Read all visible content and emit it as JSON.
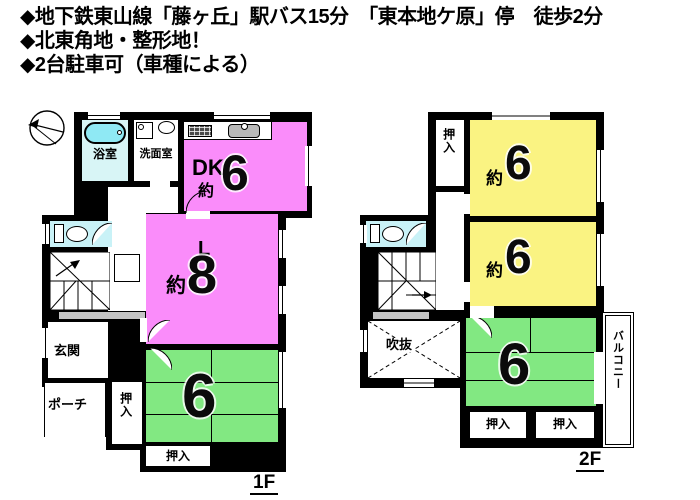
{
  "header": {
    "lines": [
      "◆地下鉄東山線「藤ヶ丘」駅バス15分　「東本地ケ原」停　徒歩2分",
      "◆北東角地・整形地！",
      "◆2台駐車可（車種による）"
    ]
  },
  "f1": {
    "label": "1F",
    "bath": "浴室",
    "wash": "洗面室",
    "dk_name": "DK",
    "dk_approx": "約",
    "dk_size": "6",
    "l_name": "L",
    "l_approx": "約",
    "l_size": "8",
    "genkan": "玄関",
    "porch": "ポーチ",
    "closet_side": "押入",
    "tatami_size": "6",
    "closet_bottom": "押入"
  },
  "f2": {
    "label": "2F",
    "closet_top": "押入",
    "r1_approx": "約",
    "r1_size": "6",
    "r2_approx": "約",
    "r2_size": "6",
    "void": "吹抜",
    "tatami_size": "6",
    "balcony": "バルコニー",
    "closet_left": "押入",
    "closet_right": "押入"
  },
  "colors": {
    "pink": "#fa8cfa",
    "green": "#82e882",
    "yellow": "#faf382",
    "cyan_floor": "#c9f2f7",
    "bath_floor": "#d8f5f6",
    "tub": "#8fe9f4",
    "gray": "#c4c4c4",
    "wall": "#000000"
  }
}
